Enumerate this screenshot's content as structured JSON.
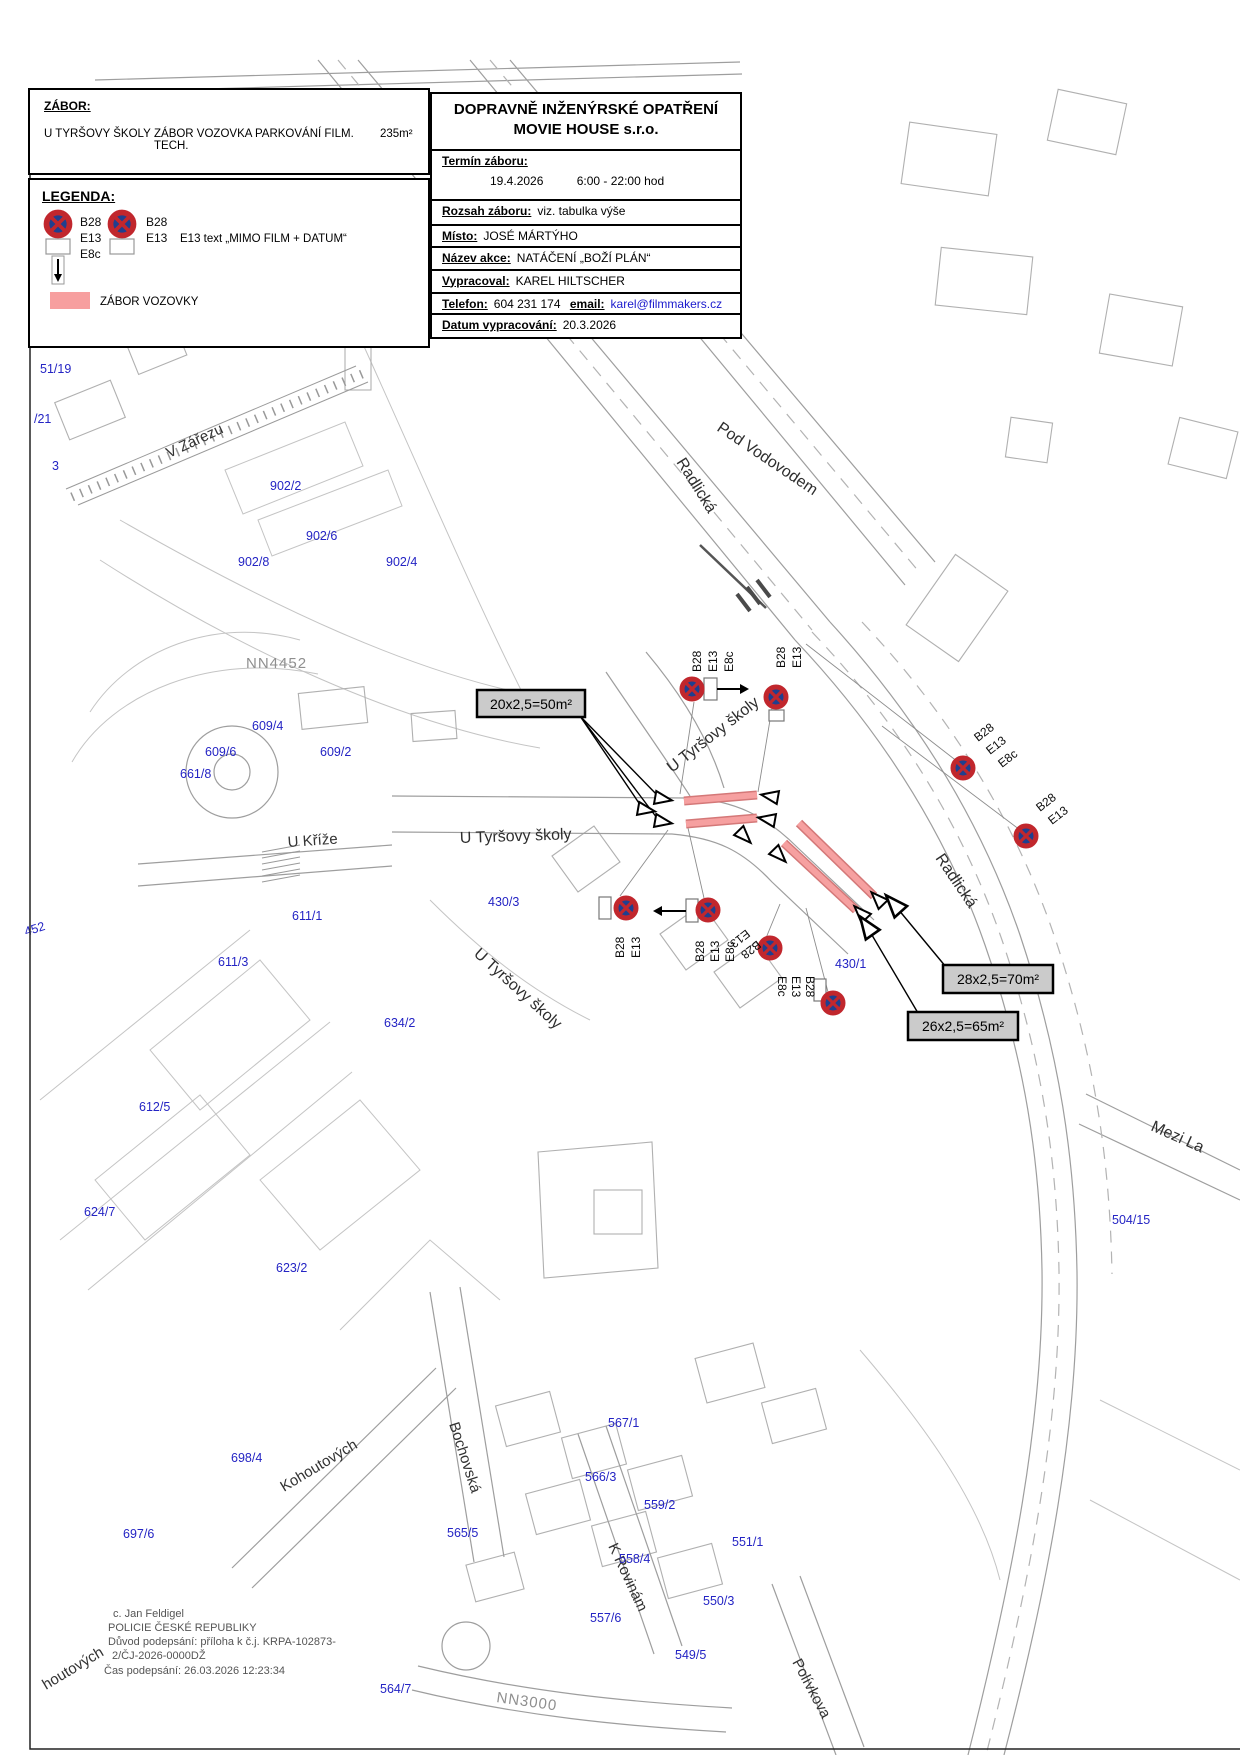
{
  "zabor": {
    "heading": "ZÁBOR:",
    "place": "U TYRŠOVY ŠKOLY",
    "desc": "ZÁBOR VOZOVKA PARKOVÁNÍ FILM. TECH.",
    "area": "235m²"
  },
  "legend": {
    "heading": "LEGENDA:",
    "item1_labels": [
      "B28",
      "E13",
      "E8c"
    ],
    "item2_labels": [
      "B28",
      "E13"
    ],
    "item2_note": "E13 text „MIMO FILM + DATUM“",
    "zone_label": "ZÁBOR VOZOVKY"
  },
  "title_block": {
    "title_line1": "DOPRAVNĚ INŽENÝRSKÉ OPATŘENÍ",
    "title_line2": "MOVIE HOUSE s.r.o.",
    "termin_label": "Termín záboru:",
    "termin_date": "19.4.2026",
    "termin_time": "6:00 - 22:00 hod",
    "rozsah_label": "Rozsah záboru:",
    "rozsah_value": "viz. tabulka výše",
    "misto_label": "Místo:",
    "misto_value": "JOSÉ MÁRTÝHO",
    "nazev_label": "Název akce:",
    "nazev_value": "NATÁČENÍ „BOŽÍ PLÁN“",
    "vypracoval_label": "Vypracoval:",
    "vypracoval_value": "KAREL HILTSCHER",
    "telefon_label": "Telefon:",
    "telefon_value": "604 231 174",
    "email_label": "email:",
    "email_value": "karel@filmmakers.cz",
    "datum_label": "Datum vypracování:",
    "datum_value": "20.3.2026"
  },
  "zone_labels": {
    "zone_a": "20x2,5=50m²",
    "zone_b": "28x2,5=70m²",
    "zone_c": "26x2,5=65m²"
  },
  "sign_codes": {
    "b28": "B28",
    "e13": "E13",
    "e8c": "E8c"
  },
  "map": {
    "street_labels": {
      "v_zarezu": "V Zářezu",
      "radlicka_top": "Radlická",
      "pod_vodovodem": "Pod Vodovodem",
      "u_tyrsovy_ne": "U Tyršovy školy",
      "u_tyrsovy_w": "U Tyršovy školy",
      "u_tyrsovy_sw": "U Tyršovy školy",
      "u_krize": "U Kříže",
      "radlicka_se": "Radlická",
      "mezi_lany": "Mezi La",
      "kohoutovych": "Kohoutových",
      "kohoutovych_partial": "houtových",
      "bochovska": "Bochovská",
      "k_rovinam": "K Rovinám",
      "polivkova": "Polívkova",
      "nn3000": "NN3000",
      "nn4452": "NN4452"
    },
    "parcel_labels": {
      "p1": "51/19",
      "p2": "/21",
      "p3": "3",
      "p4": "902/2",
      "p5": "902/6",
      "p6": "902/8",
      "p7": "902/4",
      "p8": "609/4",
      "p9": "609/6",
      "p10": "609/2",
      "p11": "661/8",
      "p12": "611/1",
      "p13": "611/3",
      "p14": "634/2",
      "p15": "612/5",
      "p16": "624/7",
      "p17": "623/2",
      "p18": "698/4",
      "p19": "697/6",
      "p20": "430/3",
      "p21": "430/1",
      "p22": "504/15",
      "p23": "567/1",
      "p24": "566/3",
      "p25": "565/5",
      "p26": "559/2",
      "p27": "558/4",
      "p28": "551/1",
      "p29": "550/3",
      "p30": "557/6",
      "p31": "549/5",
      "p32": "564/7",
      "p33": "452"
    }
  },
  "signature": {
    "line1": "c. Jan Feldigel",
    "line2": "POLICIE ČESKÉ REPUBLIKY",
    "line3": "Důvod podepsání: příloha k č.j. KRPA-102873-",
    "line4": "2/ČJ-2026-0000DŽ",
    "line5": "Čas podepsání: 26.03.2026 12:23:34"
  },
  "colors": {
    "occupation_zone": "#f6a0a0",
    "occupation_zone_edge": "#d47878",
    "sign_blue": "#1f3f8f",
    "sign_red": "#c1272d",
    "parcel_text": "#2424c4",
    "annotation_bg": "#cbcbcb",
    "email_link": "#1a1acd"
  }
}
